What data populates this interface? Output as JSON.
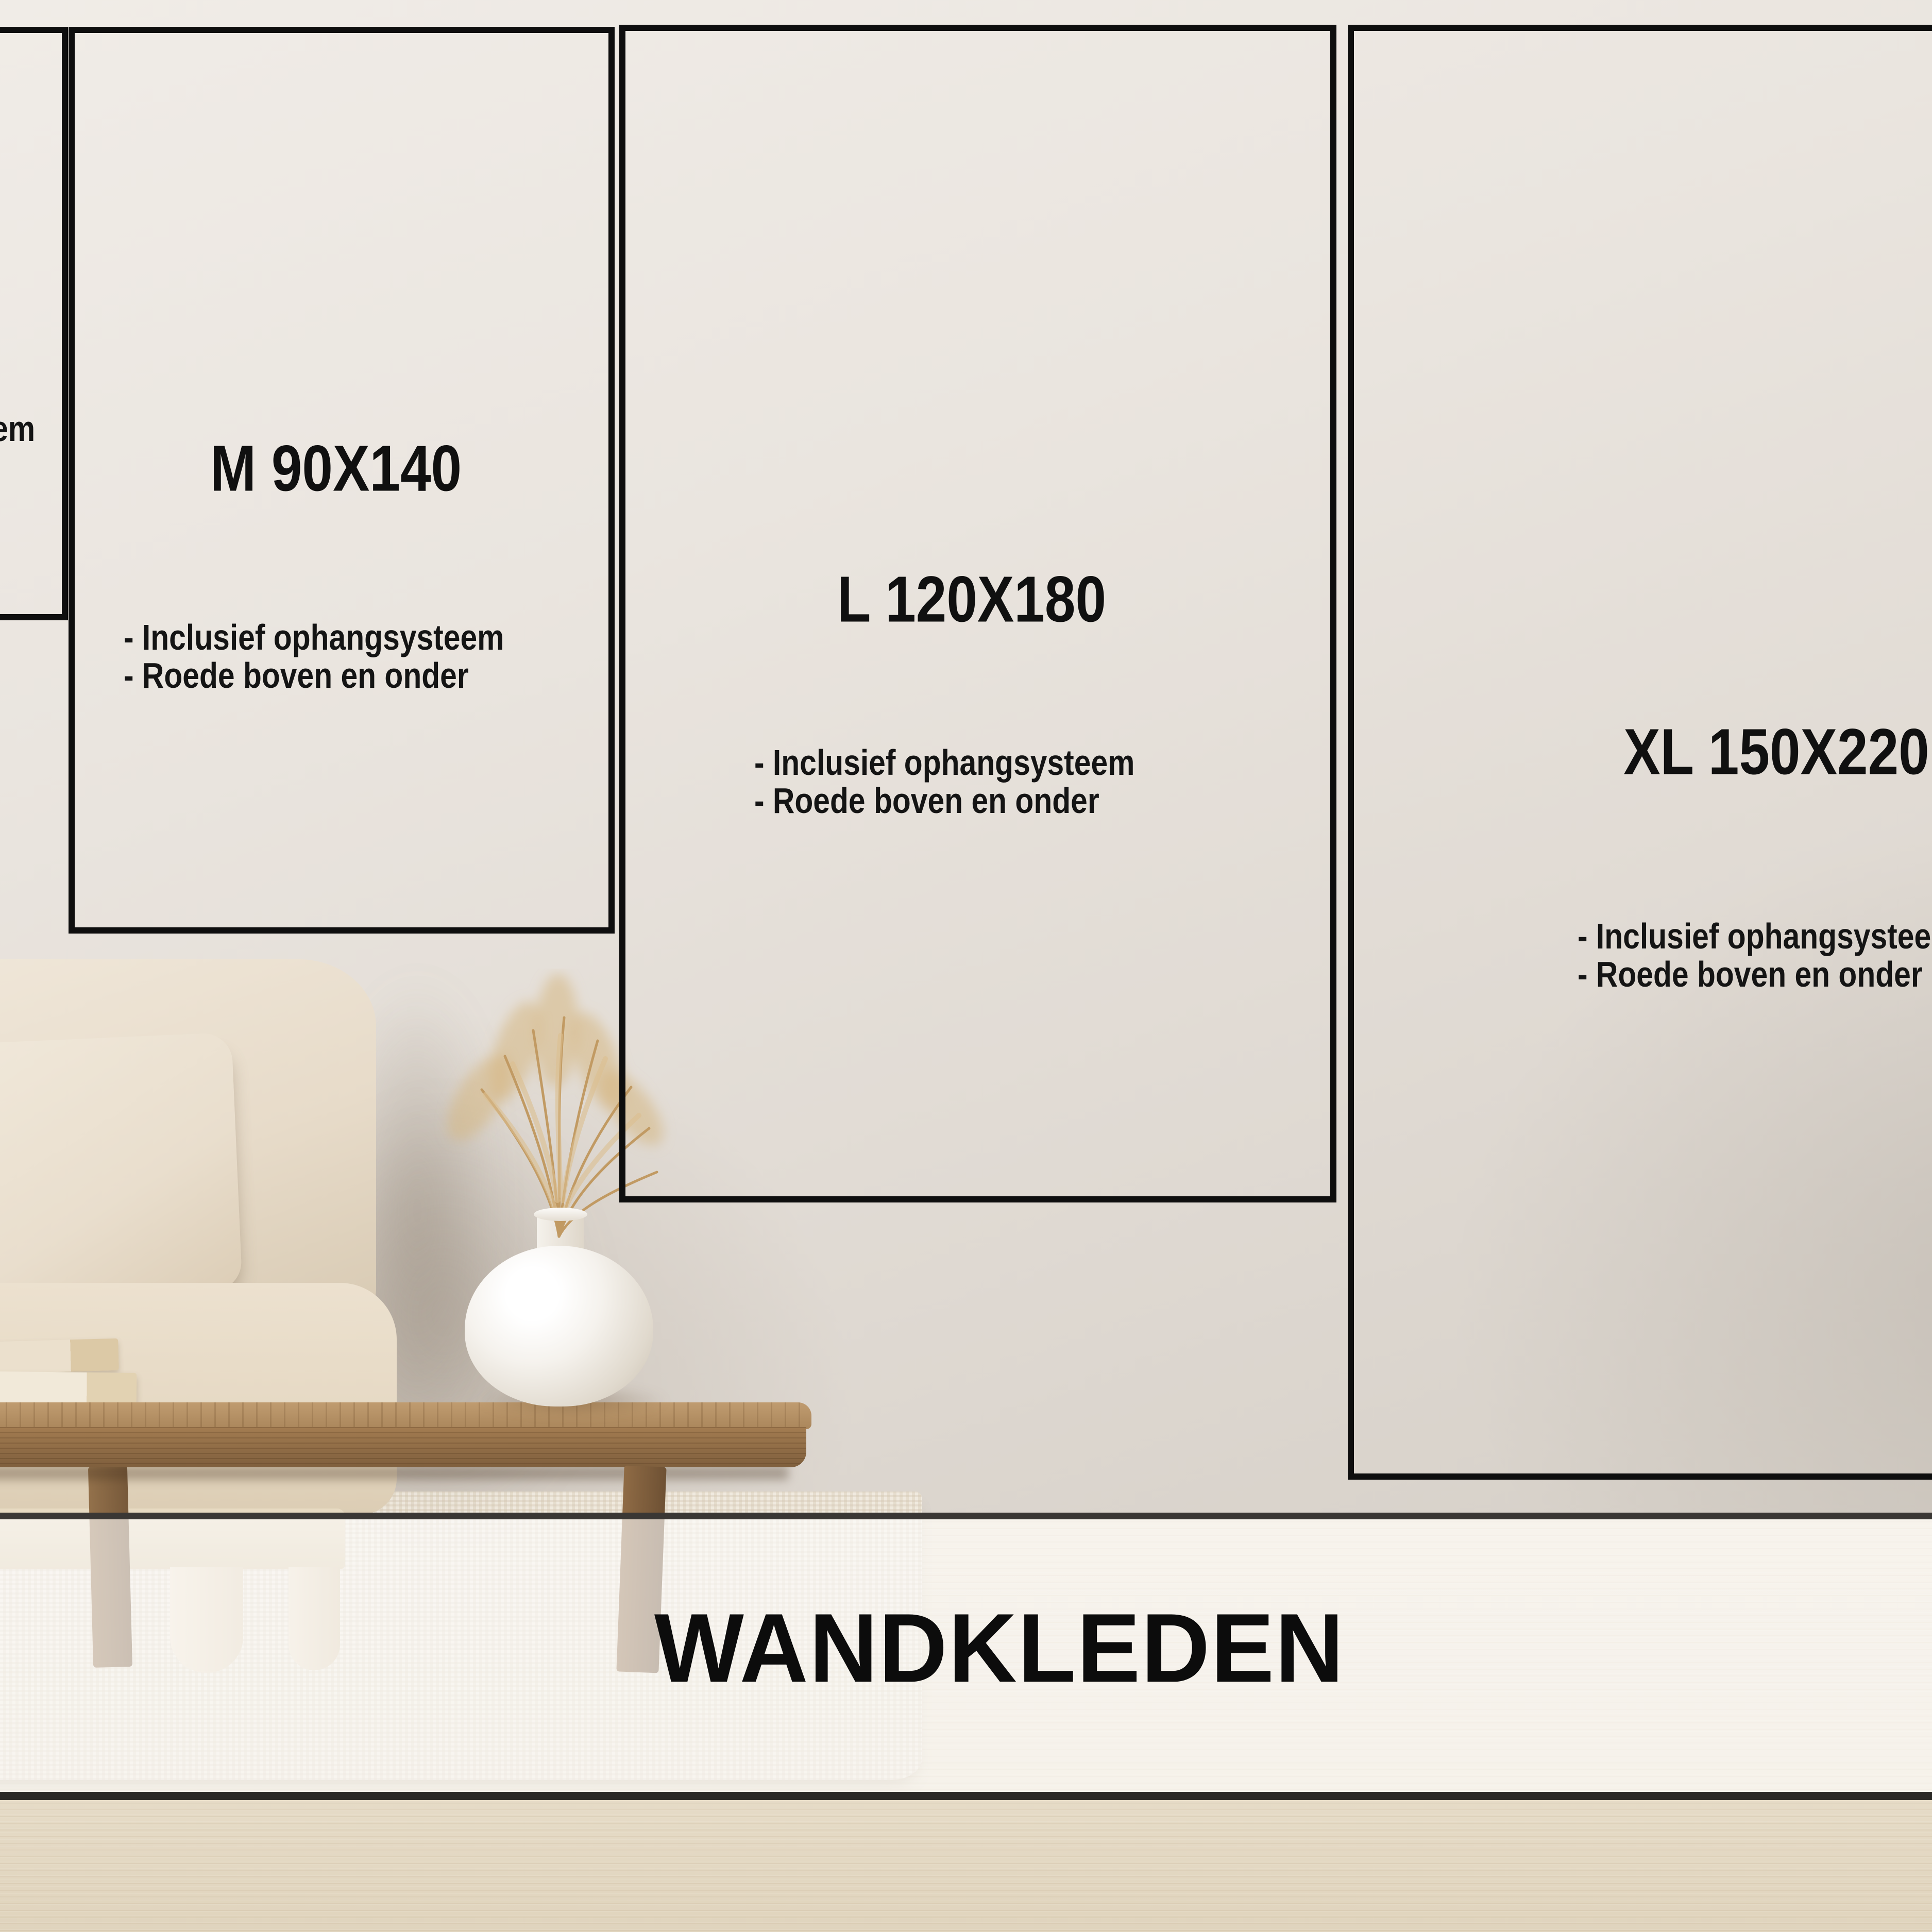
{
  "banner": {
    "title": "WANDKLEDEN"
  },
  "sizes": {
    "s": {
      "visible_fragment": "em"
    },
    "m": {
      "label": "M 90X140",
      "bullet1": "- Inclusief ophangsysteem",
      "bullet2": "- Roede boven en onder"
    },
    "l": {
      "label": "L 120X180",
      "bullet1": "- Inclusief ophangsysteem",
      "bullet2": "- Roede boven en onder"
    },
    "xl": {
      "label": "XL 150X220",
      "bullet1": "- Inclusief ophangsysteem",
      "bullet2": "- Roede boven en onder"
    }
  },
  "colors": {
    "ink": "#0e0e0e",
    "wall_light": "#f0ece7",
    "wall_dark": "#d6d0c8",
    "floor_wood": "#e8decb",
    "rug": "#f0eadf",
    "sofa_fabric": "#e7dbc9",
    "table_wood": "#a37c51",
    "vase_white": "#f5f2ed",
    "pampas_tan": "#c9a26b",
    "overlay_band": "rgba(255,255,255,0.62)",
    "band_line_top": "#3a3734",
    "band_line_bottom": "#2b2926"
  }
}
